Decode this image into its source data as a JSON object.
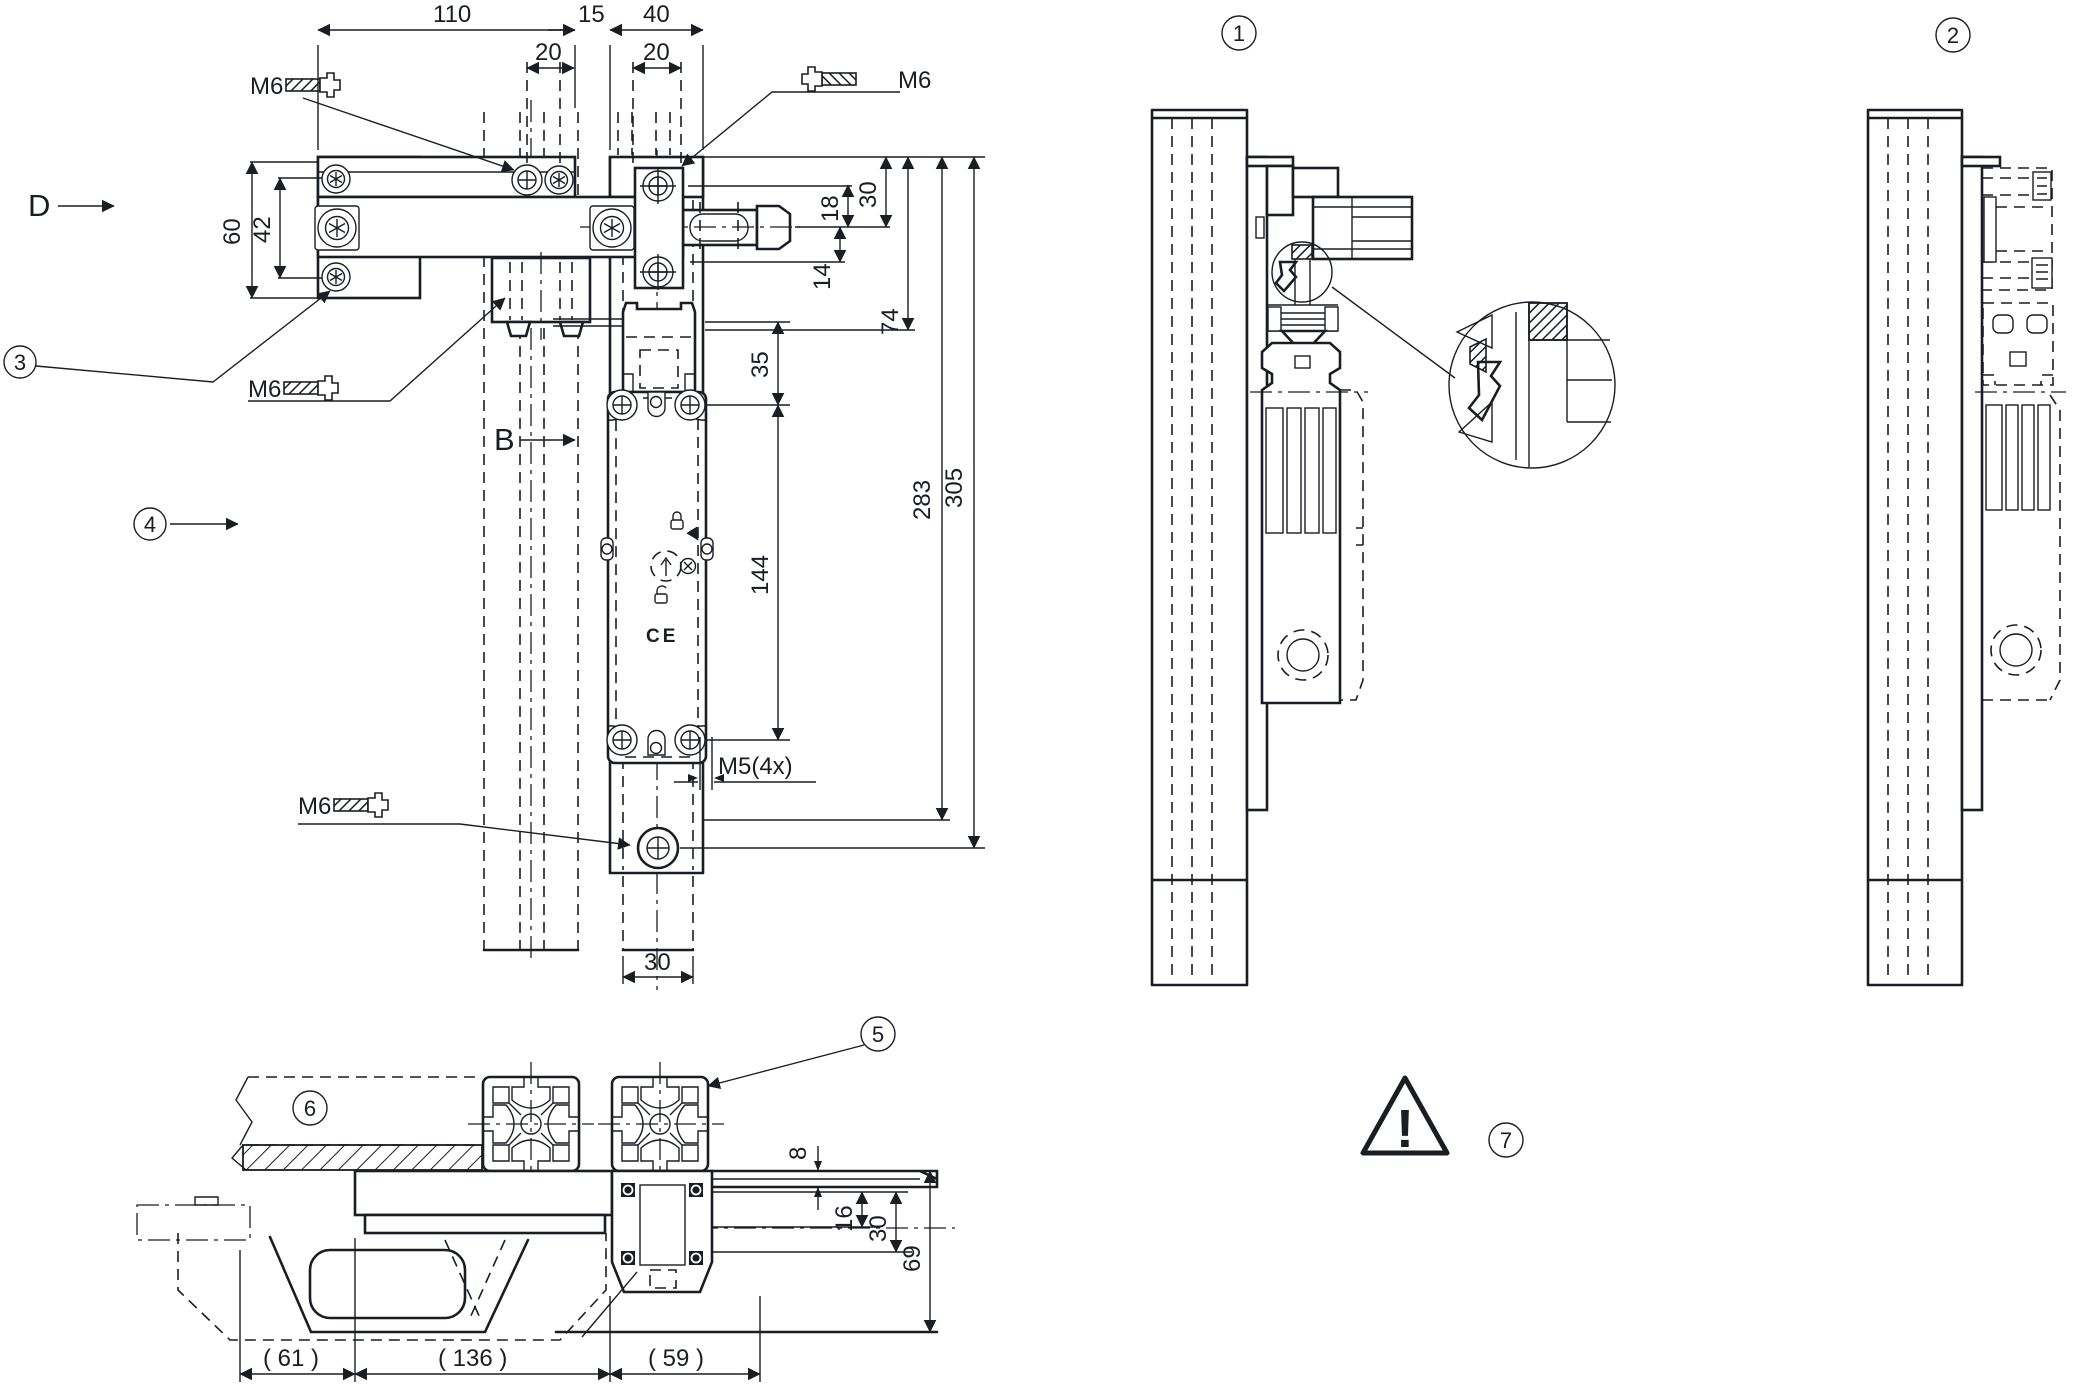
{
  "front": {
    "dims": {
      "w110": "110",
      "w15": "15",
      "w40": "40",
      "s20a": "20",
      "s20b": "20",
      "h60": "60",
      "h42": "42",
      "h30": "30",
      "h18": "18",
      "h14": "14",
      "h74": "74",
      "h35": "35",
      "h144": "144",
      "h283": "283",
      "h305": "305",
      "w30": "30"
    },
    "threads": {
      "m6_top_left": "M6",
      "m6_top_right": "M6",
      "m6_mid": "M6",
      "m6_bottom": "M6",
      "m5": "M5(4x)"
    },
    "view_labels": {
      "d": "D",
      "b": "B"
    },
    "callouts": {
      "c3": "3",
      "c4": "4"
    },
    "ce_mark": "CE"
  },
  "side_view_1": {
    "callout": "1"
  },
  "side_view_2": {
    "callout": "2"
  },
  "bottom": {
    "dims": {
      "t8": "8",
      "t16": "16",
      "t30": "30",
      "t69": "69",
      "r61": "( 61 )",
      "r136": "( 136 )",
      "r59": "( 59 )"
    },
    "callouts": {
      "c5": "5",
      "c6": "6"
    }
  },
  "warning": {
    "callout": "7",
    "symbol": "!"
  },
  "colors": {
    "line": "#1a1d24",
    "background": "#ffffff"
  }
}
